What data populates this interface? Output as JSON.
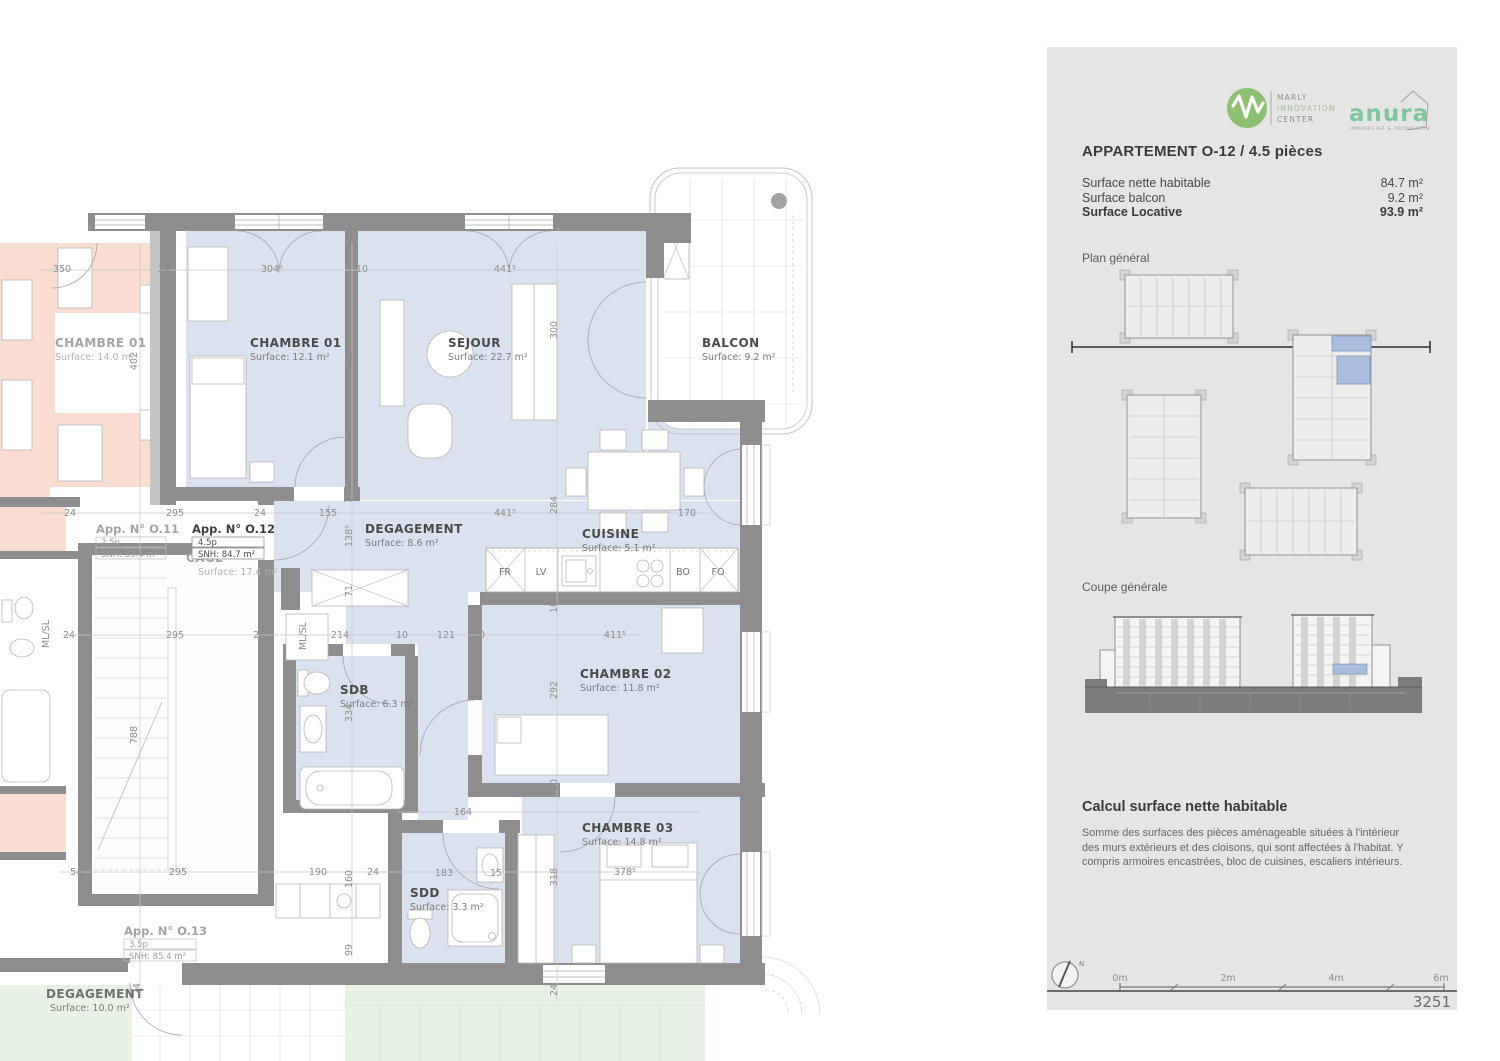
{
  "plan": {
    "rooms": [
      {
        "name": "CHAMBRE 01",
        "surface": "Surface: 14.0 m²"
      },
      {
        "name": "CHAMBRE 01",
        "surface": "Surface: 12.1 m²"
      },
      {
        "name": "SEJOUR",
        "surface": "Surface: 22.7 m²"
      },
      {
        "name": "BALCON",
        "surface": "Surface: 9.2 m²"
      },
      {
        "name": "DEGAGEMENT",
        "surface": "Surface: 8.6 m²"
      },
      {
        "name": "CUISINE",
        "surface": "Surface: 5.1 m²"
      },
      {
        "name": "CAGE",
        "surface": "Surface: 17.4 m²"
      },
      {
        "name": "SDB",
        "surface": "Surface: 6.3 m²"
      },
      {
        "name": "CHAMBRE 02",
        "surface": "Surface: 11.8 m²"
      },
      {
        "name": "SDD",
        "surface": "Surface: 3.3 m²"
      },
      {
        "name": "CHAMBRE 03",
        "surface": "Surface: 14.8 m²"
      },
      {
        "name": "DEGAGEMENT",
        "surface": "Surface: 10.0 m²"
      }
    ],
    "apartments": [
      {
        "title": "App. N° O.11",
        "type": "2.5p",
        "snh": "SNH: 53.4 m²"
      },
      {
        "title": "App. N° O.12",
        "type": "4.5p",
        "snh": "SNH: 84.7 m²"
      },
      {
        "title": "App. N° O.13",
        "type": "3.5p",
        "snh": "SNH: 85.4 m²"
      }
    ],
    "kitchen_labels": {
      "fr": "FR",
      "lv": "LV",
      "bo": "BO",
      "fo": "FO"
    },
    "closet_label": "ML/SL",
    "dims": [
      "350",
      "24",
      "304⁵",
      "10",
      "441⁵",
      "402",
      "401",
      "300",
      "24",
      "295",
      "24",
      "155",
      "441⁵",
      "284",
      "170",
      "138⁵",
      "10",
      "71",
      "214",
      "10",
      "121",
      "10",
      "411⁵",
      "24",
      "295",
      "24",
      "334",
      "292",
      "10",
      "788",
      "164",
      "54",
      "295",
      "190",
      "24",
      "160",
      "183",
      "15",
      "318",
      "378⁵",
      "99",
      "24",
      "24",
      "10"
    ]
  },
  "panel": {
    "marly_logo_lines": [
      "MARLY",
      "INNOVATION",
      "CENTER"
    ],
    "anura_logo_text": "anura",
    "anura_logo_sub": "IMMOBILIER & PROMOTION",
    "title": "APPARTEMENT O-12 / 4.5 pièces",
    "surface_rows": [
      {
        "label": "Surface nette habitable",
        "value": "84.7 m²"
      },
      {
        "label": "Surface balcon",
        "value": "9.2 m²"
      },
      {
        "label": "Surface Locative",
        "value": "93.9 m²"
      }
    ],
    "plan_general_label": "Plan général",
    "coupe_label": "Coupe générale",
    "calcul_title": "Calcul surface nette habitable",
    "calcul_text": "Somme des surfaces des pièces aménageable situées à l'intérieur des murs extérieurs et des cloisons, qui sont affectées à l'habitat. Y compris armoires encastrées, bloc de cuisines, escaliers intérieurs.",
    "compass_label": "N",
    "scale_labels": [
      "0m",
      "2m",
      "4m",
      "6m"
    ],
    "sheet_number": "3251"
  },
  "colors": {
    "accent_green": "#8fbf72",
    "anura_green": "#7fc69e",
    "highlight_blue": "#a8bedc",
    "room_blue": "#d9e2ee",
    "neighbor_pink": "#f9ddd0",
    "exterior_green": "#e7f1e4",
    "wall_gray": "#8e8e8e",
    "panel_gray": "#e5e5e3"
  }
}
